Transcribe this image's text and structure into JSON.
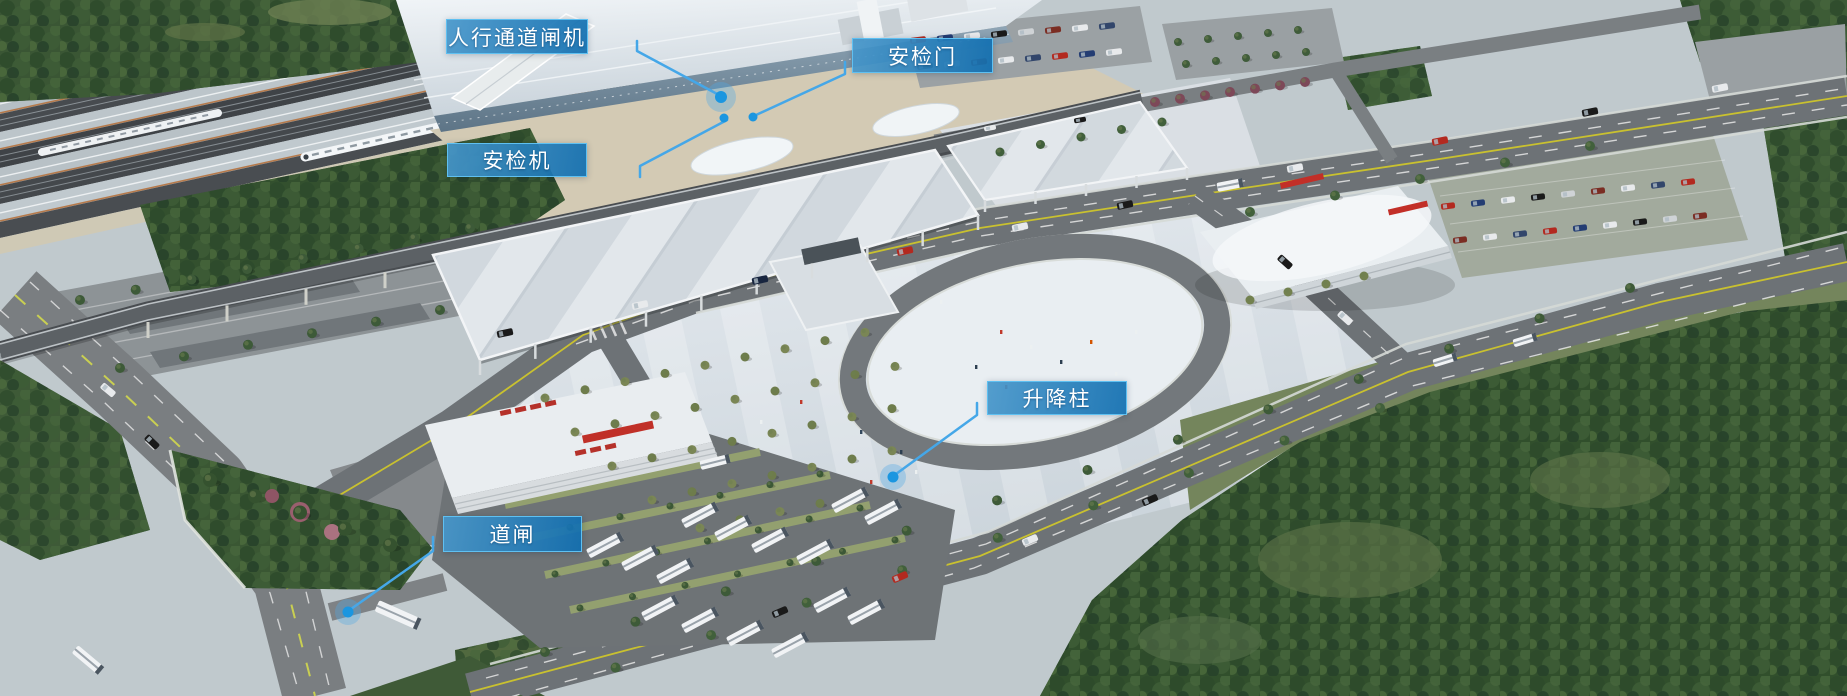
{
  "scene": {
    "kind": "aerial-architectural-render",
    "subject_labels_language": "zh-CN"
  },
  "style": {
    "label_bg_from": "#4696ca",
    "label_bg_to": "#106eb0",
    "label_border": "#5fc0f1",
    "label_text_color": "#ffffff",
    "leader_color": "#45a7e8",
    "dot_color": "#1b96e0",
    "dot_halo_color": "rgba(80,170,230,0.35)"
  },
  "annotations": [
    {
      "id": "pedestrian-channel-gate",
      "label": "人行通道闸机",
      "box": {
        "x": 446,
        "y": 19,
        "w": 142,
        "h": 35
      },
      "leader": [
        [
          637,
          41
        ],
        [
          637,
          51
        ],
        [
          719,
          95
        ]
      ],
      "dot": {
        "x": 721,
        "y": 97,
        "r": 6,
        "halo": 15
      }
    },
    {
      "id": "security-door",
      "label": "安检门",
      "box": {
        "x": 852,
        "y": 38,
        "w": 141,
        "h": 35
      },
      "leader": [
        [
          845,
          62
        ],
        [
          845,
          74
        ],
        [
          756,
          115
        ]
      ],
      "dot": {
        "x": 753,
        "y": 117,
        "r": 4.5,
        "halo": 0
      }
    },
    {
      "id": "security-scanner",
      "label": "安检机",
      "box": {
        "x": 447,
        "y": 143,
        "w": 140,
        "h": 34
      },
      "leader": [
        [
          640,
          177
        ],
        [
          640,
          166
        ],
        [
          727,
          120
        ]
      ],
      "dot": {
        "x": 724,
        "y": 118,
        "r": 4.5,
        "halo": 0
      }
    },
    {
      "id": "lifting-bollard",
      "label": "升降柱",
      "box": {
        "x": 987,
        "y": 381,
        "w": 140,
        "h": 34
      },
      "leader": [
        [
          977,
          403
        ],
        [
          977,
          415
        ],
        [
          896,
          474
        ]
      ],
      "dot": {
        "x": 893,
        "y": 477,
        "r": 5.5,
        "halo": 13
      }
    },
    {
      "id": "road-barrier",
      "label": "道闸",
      "box": {
        "x": 443,
        "y": 516,
        "w": 139,
        "h": 36
      },
      "leader": [
        [
          433,
          537
        ],
        [
          433,
          551
        ],
        [
          351,
          609
        ]
      ],
      "dot": {
        "x": 348,
        "y": 612,
        "r": 5.5,
        "halo": 13
      }
    }
  ]
}
